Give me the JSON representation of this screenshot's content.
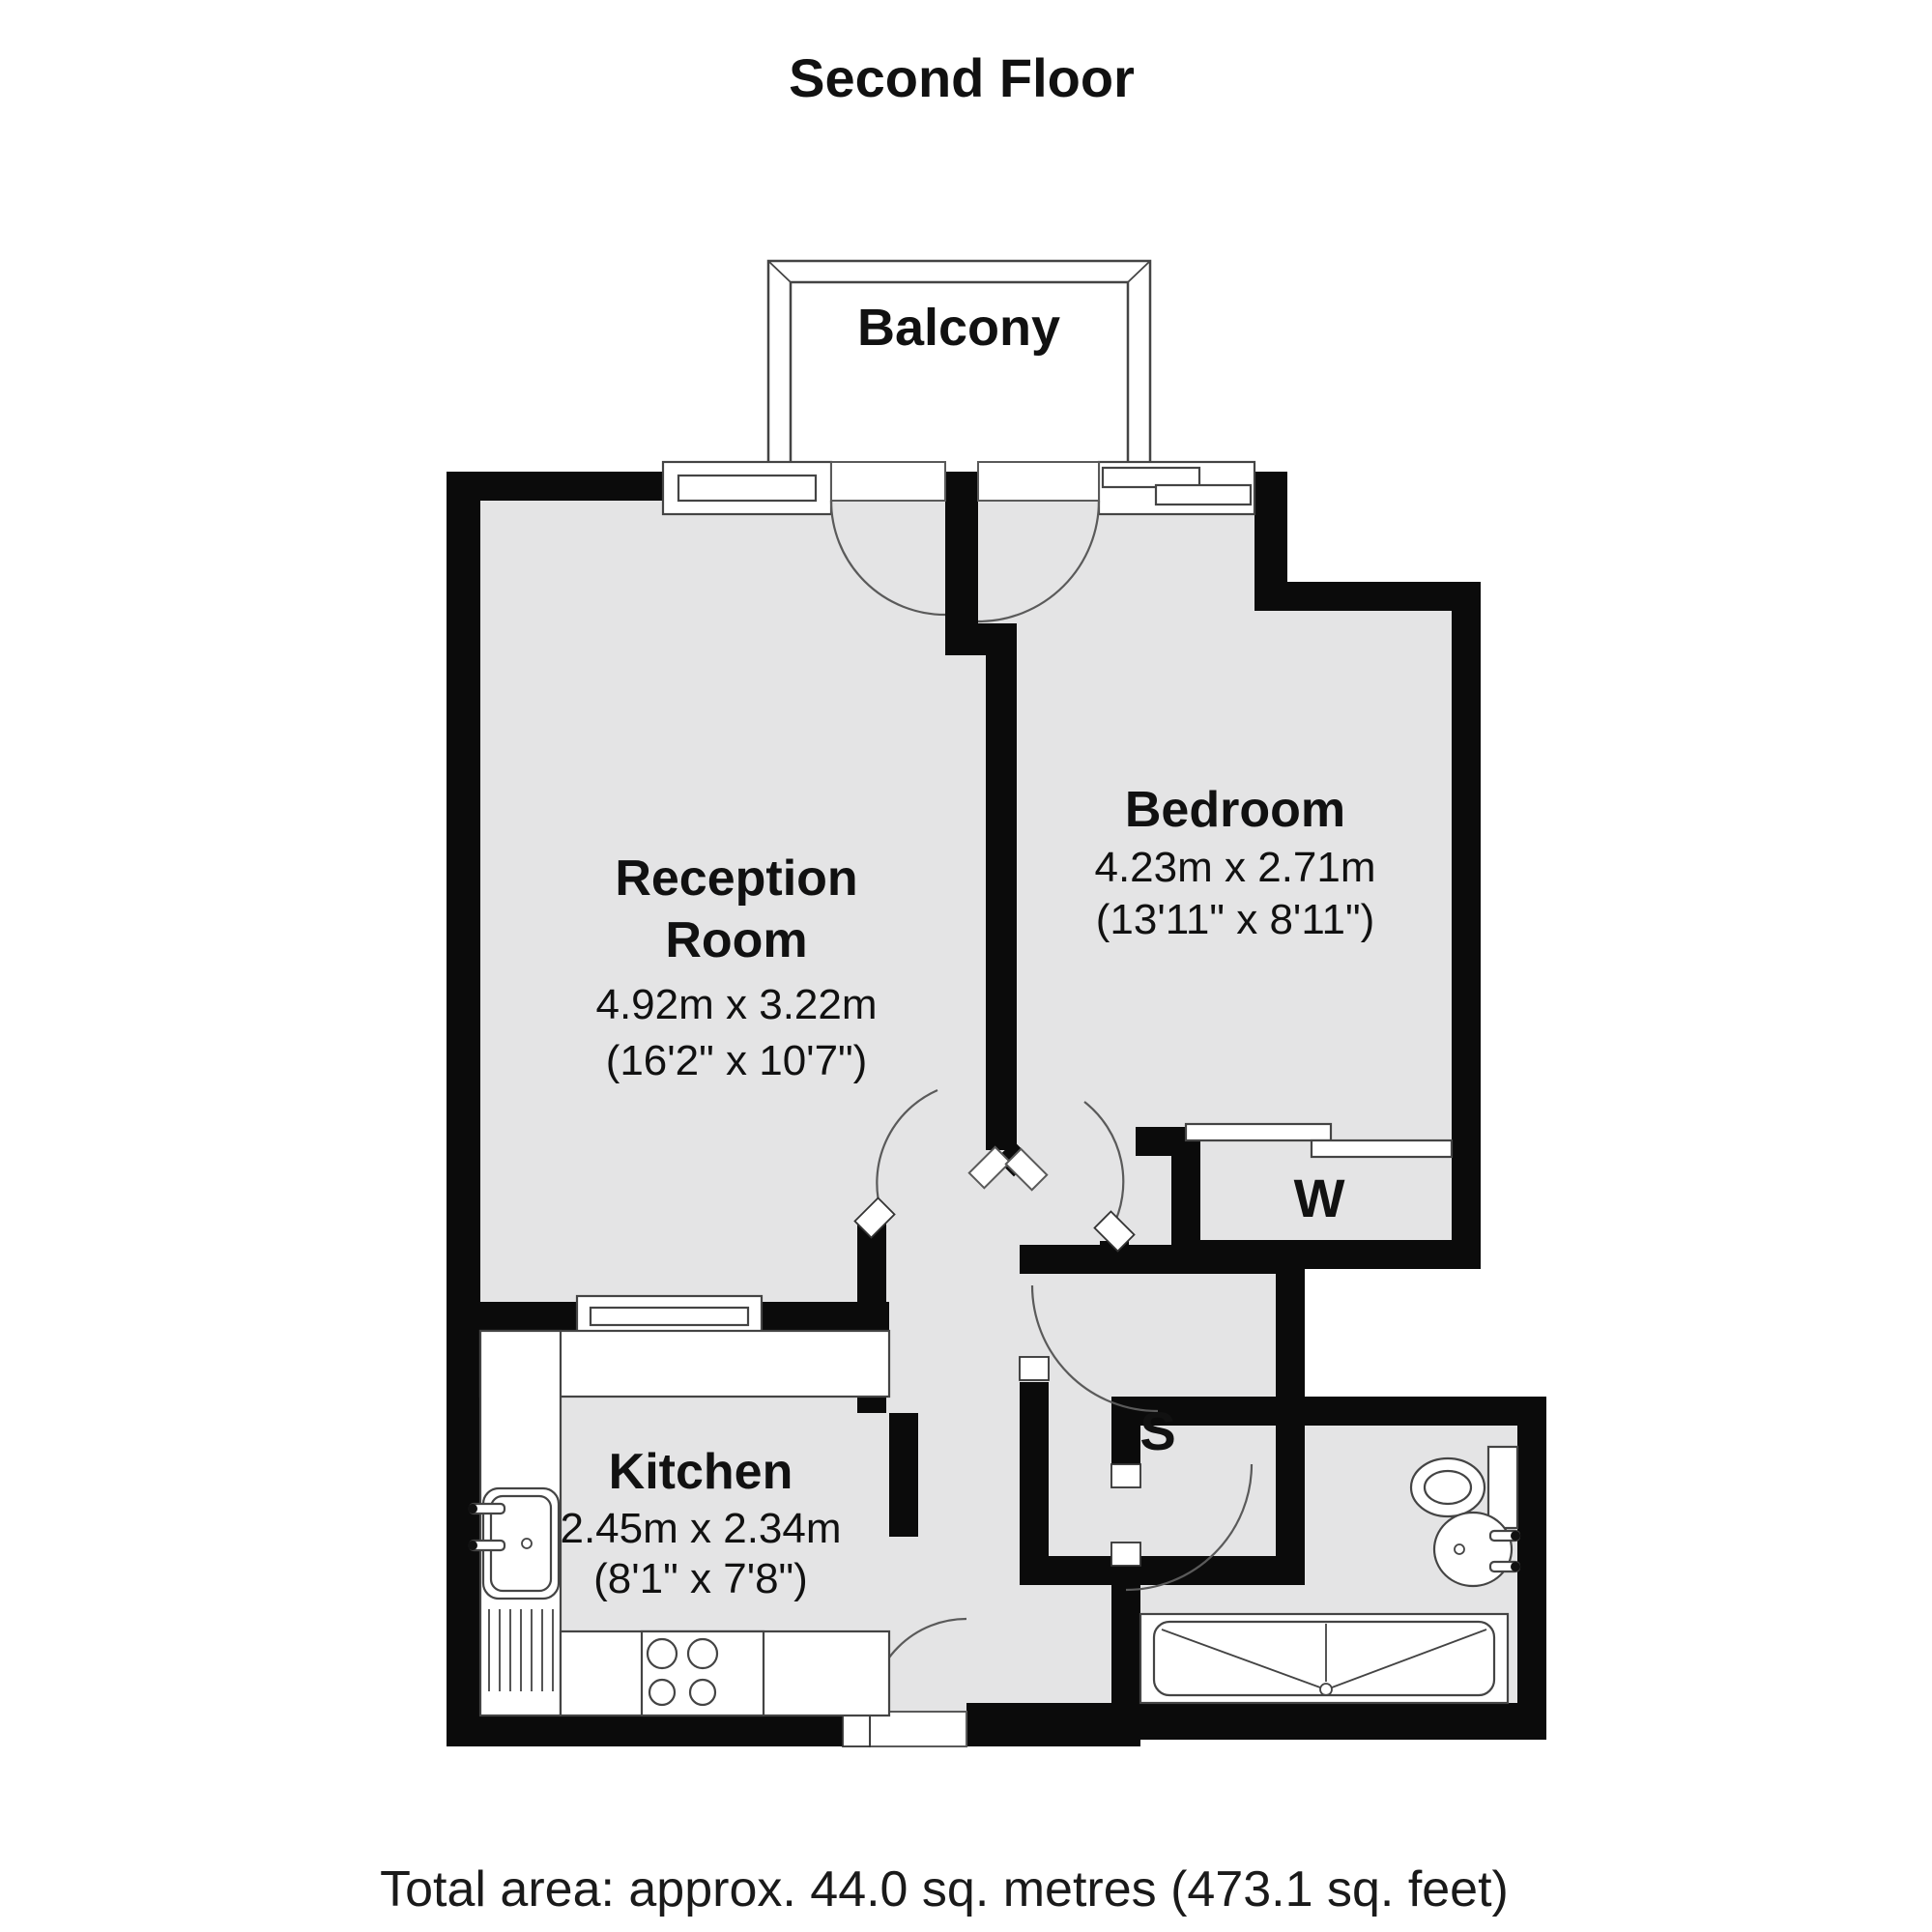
{
  "title": "Second Floor",
  "footer": {
    "total_area": "Total area: approx. 44.0 sq. metres (473.1 sq. feet)"
  },
  "rooms": {
    "balcony": {
      "label": "Balcony"
    },
    "reception": {
      "label_line1": "Reception",
      "label_line2": "Room",
      "dims_metric": "4.92m x 3.22m",
      "dims_imperial": "(16'2\" x 10'7\")"
    },
    "bedroom": {
      "label": "Bedroom",
      "dims_metric": "4.23m x 2.71m",
      "dims_imperial": "(13'11\" x 8'11\")"
    },
    "kitchen": {
      "label": "Kitchen",
      "dims_metric": "2.45m x 2.34m",
      "dims_imperial": "(8'1\" x 7'8\")"
    },
    "wardrobe": {
      "label": "W"
    },
    "storage": {
      "label": "S"
    }
  },
  "colors": {
    "wall": "#0b0b0b",
    "floor": "#e4e4e5",
    "line": "#444444"
  }
}
